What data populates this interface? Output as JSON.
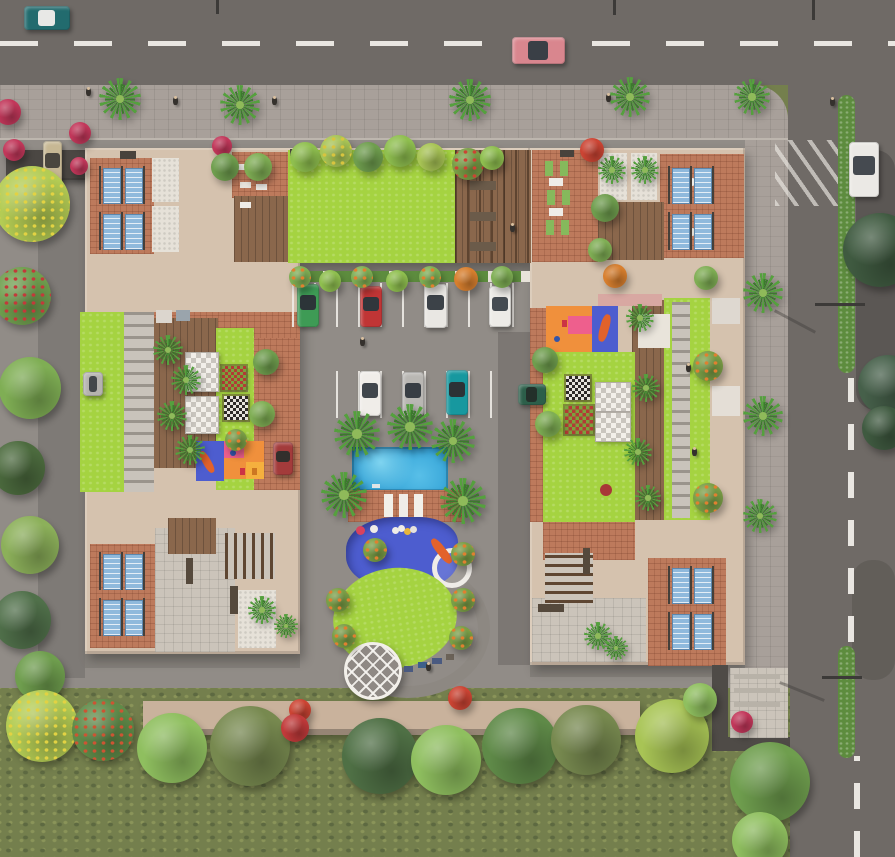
{
  "palette": {
    "road": "#6f6a66",
    "dash": "#e9e6e1",
    "sidewalk": "#a8a09a",
    "ground": "#918c87",
    "building_tan": "#d5c2ae",
    "terracotta": "#bd7a5c",
    "wood_deck": "#8a674c",
    "lawn_lime": "#a5d341",
    "pool_blue": "#2f9fd4",
    "splash_blue": "#4d5dcf",
    "slide_orange": "#e2622b",
    "solar_panel_blue": "#8fb9dc",
    "grass": "#747f4d",
    "hedge": "#5d8c3e",
    "wall_dark": "#4f4b47"
  },
  "scene": {
    "rects": [
      {
        "x": 120,
        "y": 151,
        "w": 16,
        "h": 8,
        "c": "#48423c"
      },
      {
        "x": 290,
        "y": 149,
        "w": 14,
        "h": 7,
        "c": "#48423c"
      },
      {
        "x": 560,
        "y": 150,
        "w": 14,
        "h": 7,
        "c": "#48423c"
      },
      {
        "x": 156,
        "y": 310,
        "w": 16,
        "h": 13,
        "c": "#dcd6ce"
      },
      {
        "x": 176,
        "y": 310,
        "w": 14,
        "h": 11,
        "c": "#9aa4ac"
      },
      {
        "x": 712,
        "y": 298,
        "w": 28,
        "h": 26,
        "c": "#ded8d0"
      },
      {
        "x": 712,
        "y": 386,
        "w": 28,
        "h": 30,
        "c": "#e4ded6"
      },
      {
        "x": 638,
        "y": 314,
        "w": 32,
        "h": 34,
        "c": "#e9e4db"
      },
      {
        "x": 186,
        "y": 558,
        "w": 7,
        "h": 26,
        "c": "#55493c"
      },
      {
        "x": 230,
        "y": 586,
        "w": 8,
        "h": 28,
        "c": "#55493c"
      },
      {
        "x": 583,
        "y": 548,
        "w": 7,
        "h": 26,
        "c": "#55493c"
      },
      {
        "x": 538,
        "y": 604,
        "w": 26,
        "h": 8,
        "c": "#55493c"
      },
      {
        "x": 470,
        "y": 181,
        "w": 26,
        "h": 9,
        "c": "#6b5b4a"
      },
      {
        "x": 470,
        "y": 212,
        "w": 26,
        "h": 9,
        "c": "#6b5b4a"
      },
      {
        "x": 470,
        "y": 242,
        "w": 26,
        "h": 9,
        "c": "#6b5b4a"
      },
      {
        "x": 404,
        "y": 666,
        "w": 9,
        "h": 6,
        "c": "#4a5a80"
      },
      {
        "x": 418,
        "y": 662,
        "w": 10,
        "h": 6,
        "c": "#3e5f8a"
      },
      {
        "x": 432,
        "y": 658,
        "w": 10,
        "h": 6,
        "c": "#4a5a80"
      },
      {
        "x": 446,
        "y": 654,
        "w": 8,
        "h": 6,
        "c": "#6b6258"
      },
      {
        "x": 356,
        "y": 526,
        "w": 9,
        "h": 9,
        "c": "#d8425f",
        "rad": 50
      },
      {
        "x": 370,
        "y": 525,
        "w": 8,
        "h": 8,
        "c": "#efece7",
        "rad": 50
      },
      {
        "x": 392,
        "y": 527,
        "w": 7,
        "h": 7,
        "c": "#efece7",
        "rad": 50
      },
      {
        "x": 404,
        "y": 528,
        "w": 7,
        "h": 7,
        "c": "#e8b53c",
        "rad": 50
      },
      {
        "x": 398,
        "y": 525,
        "w": 7,
        "h": 7,
        "c": "#efece7",
        "rad": 50
      },
      {
        "x": 410,
        "y": 526,
        "w": 7,
        "h": 7,
        "c": "#e6e2dc",
        "rad": 50
      },
      {
        "x": 384,
        "y": 494,
        "w": 9,
        "h": 23,
        "c": "#f2efe9"
      },
      {
        "x": 399,
        "y": 494,
        "w": 9,
        "h": 23,
        "c": "#efece7"
      },
      {
        "x": 414,
        "y": 494,
        "w": 9,
        "h": 23,
        "c": "#f2efe9"
      },
      {
        "x": 437,
        "y": 536,
        "w": 9,
        "h": 30,
        "c": "#e2622b",
        "rot": -38,
        "rad": 40
      },
      {
        "x": 240,
        "y": 468,
        "w": 5,
        "h": 7,
        "c": "#cc3344"
      },
      {
        "x": 252,
        "y": 468,
        "w": 5,
        "h": 7,
        "c": "#cc7722"
      },
      {
        "x": 230,
        "y": 450,
        "w": 6,
        "h": 6,
        "c": "#3355aa",
        "rad": 50
      },
      {
        "x": 562,
        "y": 320,
        "w": 5,
        "h": 7,
        "c": "#cc3344"
      },
      {
        "x": 554,
        "y": 336,
        "w": 6,
        "h": 6,
        "c": "#3355aa",
        "rad": 50
      },
      {
        "x": 238,
        "y": 164,
        "w": 11,
        "h": 6,
        "c": "#efece7"
      },
      {
        "x": 254,
        "y": 166,
        "w": 11,
        "h": 6,
        "c": "#efece7"
      },
      {
        "x": 240,
        "y": 182,
        "w": 11,
        "h": 6,
        "c": "#e7e3dc"
      },
      {
        "x": 256,
        "y": 184,
        "w": 11,
        "h": 6,
        "c": "#efece7"
      },
      {
        "x": 240,
        "y": 202,
        "w": 11,
        "h": 6,
        "c": "#efece7"
      },
      {
        "x": 545,
        "y": 161,
        "w": 8,
        "h": 15,
        "c": "#86b95c"
      },
      {
        "x": 560,
        "y": 161,
        "w": 8,
        "h": 15,
        "c": "#86b95c"
      },
      {
        "x": 547,
        "y": 190,
        "w": 8,
        "h": 15,
        "c": "#86b95c"
      },
      {
        "x": 562,
        "y": 190,
        "w": 8,
        "h": 15,
        "c": "#86b95c"
      },
      {
        "x": 546,
        "y": 220,
        "w": 8,
        "h": 15,
        "c": "#86b95c"
      },
      {
        "x": 561,
        "y": 220,
        "w": 8,
        "h": 15,
        "c": "#86b95c"
      },
      {
        "x": 549,
        "y": 178,
        "w": 14,
        "h": 8,
        "c": "#efece7"
      },
      {
        "x": 549,
        "y": 208,
        "w": 14,
        "h": 8,
        "c": "#efece7"
      },
      {
        "x": 600,
        "y": 314,
        "w": 9,
        "h": 28,
        "c": "#e2622b",
        "rot": 15,
        "rad": 40
      },
      {
        "x": 203,
        "y": 450,
        "w": 8,
        "h": 24,
        "c": "#e2622b",
        "rot": -30,
        "rad": 40
      },
      {
        "x": 734,
        "y": 674,
        "w": 46,
        "h": 5,
        "c": "#b8b2a8"
      },
      {
        "x": 734,
        "y": 688,
        "w": 46,
        "h": 5,
        "c": "#b8b2a8"
      },
      {
        "x": 734,
        "y": 702,
        "w": 46,
        "h": 5,
        "c": "#b8b2a8"
      },
      {
        "x": 600,
        "y": 484,
        "w": 12,
        "h": 12,
        "c": "#a83838",
        "rad": 50
      },
      {
        "x": 372,
        "y": 484,
        "w": 8,
        "h": 4,
        "c": "#dfe4e6"
      },
      {
        "x": 688,
        "y": 178,
        "w": 8,
        "h": 8,
        "c": "#efece7",
        "rad": 50
      },
      {
        "x": 688,
        "y": 228,
        "w": 8,
        "h": 8,
        "c": "#e0dcd4",
        "rad": 50
      }
    ],
    "panels": [
      [
        99,
        166
      ],
      [
        99,
        212
      ],
      [
        99,
        552
      ],
      [
        99,
        598
      ],
      [
        668,
        166
      ],
      [
        668,
        212
      ],
      [
        668,
        566
      ],
      [
        668,
        612
      ]
    ],
    "checkers": [
      {
        "x": 222,
        "y": 366,
        "s": 24,
        "a": "#b23b35",
        "b": "#7ba23e"
      },
      {
        "x": 224,
        "y": 396,
        "s": 24,
        "a": "#2e2a28",
        "b": "#e8e4de"
      },
      {
        "x": 566,
        "y": 376,
        "s": 24,
        "a": "#2e2a28",
        "b": "#e8e4de"
      },
      {
        "x": 565,
        "y": 406,
        "s": 28,
        "a": "#b23b35",
        "b": "#7ba23e"
      }
    ],
    "tables": [
      {
        "x": 185,
        "y": 352,
        "w": 32,
        "h": 38
      },
      {
        "x": 185,
        "y": 396,
        "w": 32,
        "h": 36
      },
      {
        "x": 595,
        "y": 382,
        "w": 34,
        "h": 28
      },
      {
        "x": 595,
        "y": 412,
        "w": 34,
        "h": 28
      }
    ],
    "cars": [
      {
        "n": "street-car-teal",
        "x": 24,
        "y": 6,
        "w": 46,
        "h": 24,
        "c": "#226b6e",
        "g": "#e8e8e6",
        "dir": "h"
      },
      {
        "n": "street-car-red",
        "x": 512,
        "y": 37,
        "w": 53,
        "h": 27,
        "c": "#d9868e",
        "g": "#3a3f46",
        "dir": "h"
      },
      {
        "n": "street-car-white",
        "x": 849,
        "y": 142,
        "w": 30,
        "h": 55,
        "c": "#ebe9e5",
        "g": "#454a50",
        "dir": "v"
      },
      {
        "n": "parked-car-green",
        "x": 297,
        "y": 284,
        "w": 22,
        "h": 43,
        "c": "#3e9b55",
        "g": "#2c3438",
        "dir": "v"
      },
      {
        "n": "parked-car-red",
        "x": 360,
        "y": 286,
        "w": 22,
        "h": 41,
        "c": "#c03535",
        "g": "#30363c",
        "dir": "v"
      },
      {
        "n": "parked-car-white",
        "x": 424,
        "y": 284,
        "w": 23,
        "h": 44,
        "c": "#e9e7e3",
        "g": "#3c4248",
        "dir": "v"
      },
      {
        "n": "parked-car-white",
        "x": 489,
        "y": 286,
        "w": 22,
        "h": 41,
        "c": "#edebe7",
        "g": "#454b51",
        "dir": "v"
      },
      {
        "n": "parked-car-white",
        "x": 359,
        "y": 371,
        "w": 22,
        "h": 45,
        "c": "#f0ede9",
        "g": "#40464c",
        "dir": "v"
      },
      {
        "n": "parked-car-silver",
        "x": 402,
        "y": 372,
        "w": 22,
        "h": 44,
        "c": "#b9b7b3",
        "g": "#383e44",
        "dir": "v"
      },
      {
        "n": "parked-car-teal",
        "x": 446,
        "y": 370,
        "w": 22,
        "h": 45,
        "c": "#17989f",
        "g": "#2c3236",
        "dir": "v"
      },
      {
        "n": "parked-car-darkred",
        "x": 273,
        "y": 442,
        "w": 20,
        "h": 33,
        "c": "#a33b3b",
        "g": "#332f2c",
        "dir": "v"
      },
      {
        "n": "parked-car-darkgreen",
        "x": 518,
        "y": 384,
        "w": 28,
        "h": 21,
        "c": "#2c5f4a",
        "g": "#23302a",
        "dir": "h"
      },
      {
        "n": "parked-car-beige",
        "x": 43,
        "y": 141,
        "w": 19,
        "h": 45,
        "c": "#c7b894",
        "g": "#4a463e",
        "dir": "v"
      },
      {
        "n": "parked-car-silver",
        "x": 83,
        "y": 372,
        "w": 20,
        "h": 24,
        "c": "#b5b3af",
        "g": "#43474b",
        "dir": "h"
      }
    ],
    "lamps": [
      {
        "x": 216,
        "y": 0,
        "w": 3,
        "h": 14
      },
      {
        "x": 613,
        "y": 0,
        "w": 3,
        "h": 15
      },
      {
        "x": 812,
        "y": 0,
        "w": 3,
        "h": 20
      },
      {
        "x": 815,
        "y": 303,
        "w": 50,
        "h": 3
      },
      {
        "x": 772,
        "y": 320,
        "w": 46,
        "h": 3,
        "rot": 28,
        "o": 0.4
      },
      {
        "x": 822,
        "y": 676,
        "w": 40,
        "h": 3
      },
      {
        "x": 778,
        "y": 690,
        "w": 48,
        "h": 3,
        "rot": 22,
        "o": 0.4
      }
    ],
    "persons": [
      [
        88,
        92
      ],
      [
        175,
        101
      ],
      [
        274,
        101
      ],
      [
        608,
        98
      ],
      [
        832,
        102
      ],
      [
        688,
        368
      ],
      [
        694,
        452
      ],
      [
        428,
        667
      ],
      [
        362,
        342
      ],
      [
        512,
        228
      ]
    ],
    "palms": [
      [
        120,
        99,
        21
      ],
      [
        240,
        105,
        20
      ],
      [
        470,
        100,
        21
      ],
      [
        630,
        97,
        20
      ],
      [
        752,
        97,
        18
      ],
      [
        763,
        293,
        20
      ],
      [
        763,
        416,
        20
      ],
      [
        760,
        516,
        17
      ],
      [
        357,
        434,
        23
      ],
      [
        410,
        427,
        23
      ],
      [
        453,
        441,
        22
      ],
      [
        344,
        495,
        23
      ],
      [
        463,
        501,
        23
      ],
      [
        168,
        350,
        15
      ],
      [
        186,
        380,
        15
      ],
      [
        172,
        416,
        15
      ],
      [
        190,
        450,
        15
      ],
      [
        640,
        318,
        14
      ],
      [
        646,
        388,
        14
      ],
      [
        638,
        452,
        14
      ],
      [
        648,
        498,
        13
      ],
      [
        262,
        610,
        14
      ],
      [
        286,
        626,
        12
      ],
      [
        598,
        636,
        14
      ],
      [
        616,
        648,
        12
      ],
      [
        612,
        170,
        14
      ],
      [
        645,
        170,
        14
      ]
    ],
    "trees": [
      [
        32,
        204,
        38,
        "#b4cc54",
        "#e2d243"
      ],
      [
        22,
        296,
        29,
        "#6f9e4e",
        "#c23a3a"
      ],
      [
        30,
        388,
        31,
        "#7fae54"
      ],
      [
        18,
        468,
        27,
        "#4c6b3e"
      ],
      [
        30,
        545,
        29,
        "#8cb05a"
      ],
      [
        22,
        620,
        29,
        "#50704a"
      ],
      [
        40,
        676,
        25,
        "#6f9e4e"
      ],
      [
        8,
        112,
        13,
        "#c2375a"
      ],
      [
        14,
        150,
        11,
        "#c2375a"
      ],
      [
        80,
        133,
        11,
        "#c2375a"
      ],
      [
        79,
        166,
        9,
        "#c2375a"
      ],
      [
        222,
        146,
        10,
        "#c2375a"
      ],
      [
        225,
        167,
        14,
        "#6f9e4e"
      ],
      [
        258,
        167,
        14,
        "#7fae54"
      ],
      [
        305,
        157,
        15,
        "#8fbf4f"
      ],
      [
        336,
        151,
        16,
        "#a8c455",
        "#d8c43f"
      ],
      [
        368,
        157,
        15,
        "#6f9e4e"
      ],
      [
        400,
        151,
        16,
        "#8fbf4f"
      ],
      [
        431,
        157,
        14,
        "#a8c455"
      ],
      [
        468,
        164,
        16,
        "#7a9e46",
        "#cc4433"
      ],
      [
        492,
        158,
        12,
        "#8fbf4f"
      ],
      [
        592,
        150,
        12,
        "#cc4433"
      ],
      [
        300,
        277,
        11,
        "#7fae54",
        "#e08030"
      ],
      [
        330,
        281,
        11,
        "#8fbf4f"
      ],
      [
        362,
        277,
        11,
        "#7fae54",
        "#e08030"
      ],
      [
        397,
        281,
        11,
        "#8fbf4f"
      ],
      [
        430,
        277,
        11,
        "#7fae54",
        "#e08030"
      ],
      [
        466,
        279,
        12,
        "#d87f2e"
      ],
      [
        502,
        277,
        11,
        "#7fae54"
      ],
      [
        615,
        276,
        12,
        "#d87f2e"
      ],
      [
        706,
        278,
        12,
        "#7fae54"
      ],
      [
        545,
        360,
        13,
        "#6f9e4e"
      ],
      [
        548,
        424,
        13,
        "#7fae54"
      ],
      [
        266,
        362,
        13,
        "#6f9e4e"
      ],
      [
        262,
        414,
        13,
        "#7fae54"
      ],
      [
        236,
        440,
        11,
        "#7a9e46",
        "#e08030"
      ],
      [
        708,
        366,
        15,
        "#7a9e46",
        "#e08030"
      ],
      [
        708,
        498,
        15,
        "#7a9e46",
        "#e08030"
      ],
      [
        605,
        208,
        14,
        "#6f9e4e"
      ],
      [
        600,
        250,
        12,
        "#7fae54"
      ],
      [
        375,
        550,
        12,
        "#7a9e46",
        "#e08030"
      ],
      [
        463,
        554,
        12,
        "#7a9e46",
        "#e08030"
      ],
      [
        338,
        600,
        12,
        "#7a9e46",
        "#e08030"
      ],
      [
        344,
        636,
        12,
        "#7a9e46",
        "#e08030"
      ],
      [
        463,
        600,
        12,
        "#7a9e46",
        "#e08030"
      ],
      [
        461,
        638,
        12,
        "#7a9e46",
        "#e08030"
      ],
      [
        460,
        698,
        12,
        "#cc4433"
      ],
      [
        742,
        722,
        11,
        "#c2375a"
      ],
      [
        300,
        710,
        11,
        "#cc4433"
      ],
      [
        42,
        726,
        36,
        "#b4cc54",
        "#e2d243"
      ],
      [
        103,
        730,
        31,
        "#5f8a48",
        "#cc5533"
      ],
      [
        172,
        748,
        35,
        "#8fbf5f"
      ],
      [
        250,
        746,
        40,
        "#77894f"
      ],
      [
        295,
        728,
        14,
        "#c23a3a"
      ],
      [
        380,
        756,
        38,
        "#4f7045"
      ],
      [
        446,
        760,
        35,
        "#8fbf5f"
      ],
      [
        520,
        746,
        38,
        "#5f8a48"
      ],
      [
        586,
        740,
        35,
        "#77894f"
      ],
      [
        672,
        736,
        37,
        "#a8c455"
      ],
      [
        700,
        700,
        17,
        "#8fbf5f"
      ],
      [
        770,
        782,
        40,
        "#6f9e4e"
      ],
      [
        760,
        840,
        28,
        "#8fbf5f"
      ],
      [
        880,
        250,
        37,
        "#3f5a40"
      ],
      [
        888,
        385,
        30,
        "#46604a"
      ],
      [
        884,
        428,
        22,
        "#3f5a40"
      ]
    ]
  }
}
